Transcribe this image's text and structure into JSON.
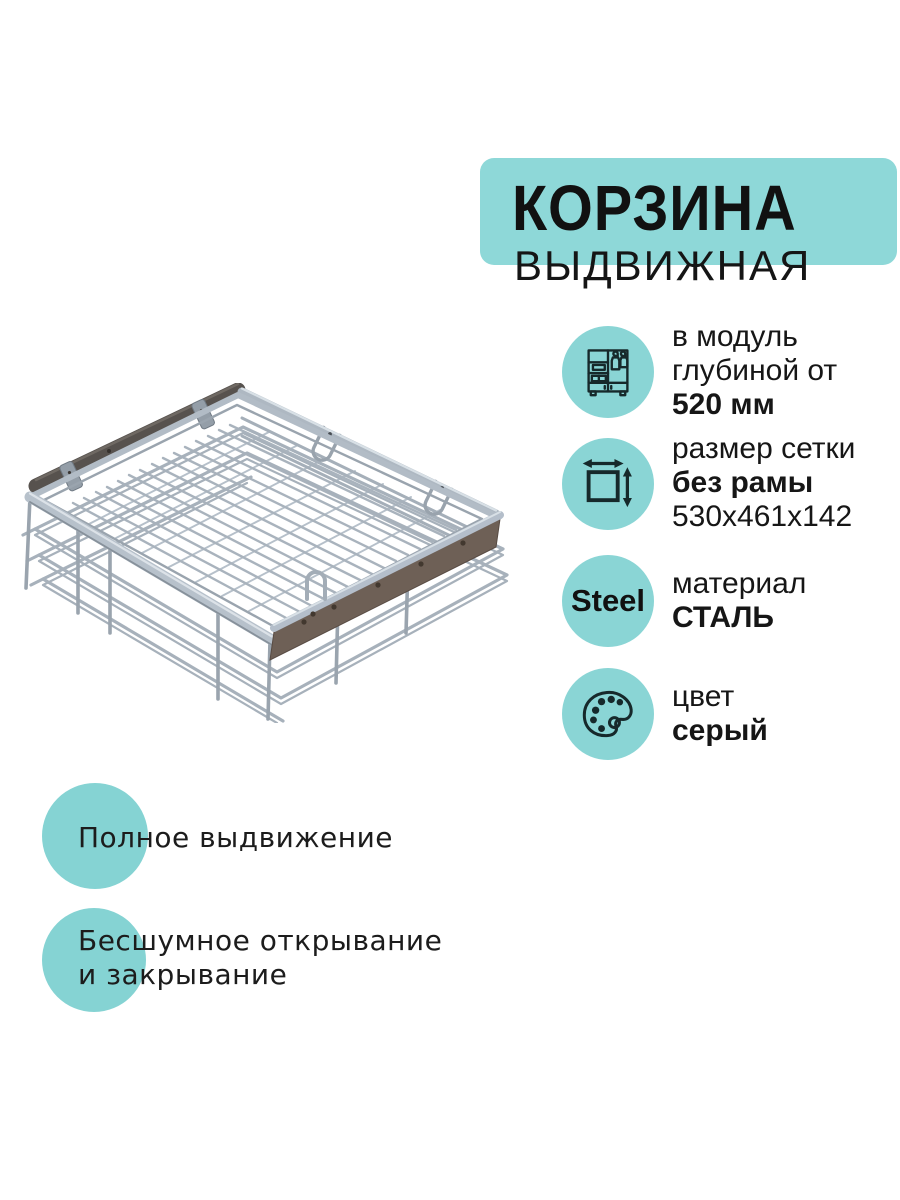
{
  "badge": {
    "title": "КОРЗИНА",
    "subtitle": "ВЫДВИЖНАЯ"
  },
  "specs": {
    "module": {
      "icon": "wardrobe-icon",
      "line1": "в модуль",
      "line2": "глубиной от",
      "line3": "520 мм"
    },
    "grid": {
      "icon": "dimensions-icon",
      "line1": "размер сетки",
      "line2": "без рамы",
      "line3": "530х461х142"
    },
    "material": {
      "circle_text": "Steel",
      "line1": "материал",
      "line2": "СТАЛЬ"
    },
    "color": {
      "icon": "palette-icon",
      "line1": "цвет",
      "line2": "серый"
    }
  },
  "features": {
    "full_extension": "Полное выдвижение",
    "quiet_line1": "Бесшумное открывание",
    "quiet_line2": "и закрывание"
  },
  "colors": {
    "badge_teal": "#8ED8D8",
    "circle_teal": "#8AD5D5",
    "feature_teal": "#85D3D3",
    "icon_ink": "#16292B",
    "text_ink": "#161616",
    "steel_wire": "#AAB4BE",
    "panel_brown": "#6E6056",
    "panel_dark": "#57524E"
  }
}
